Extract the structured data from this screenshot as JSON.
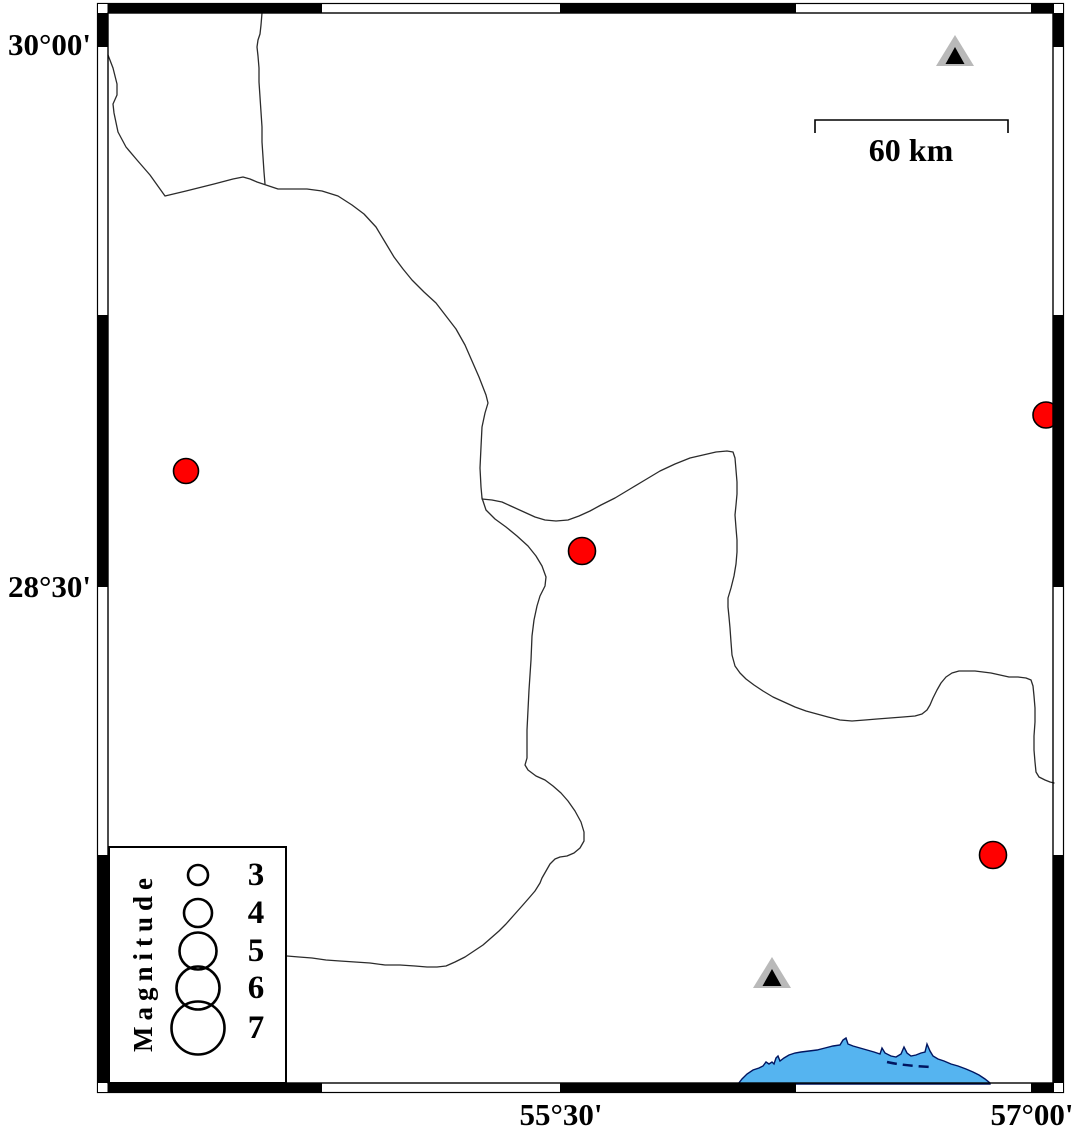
{
  "map": {
    "lat_labels": [
      {
        "text": "30°00'"
      },
      {
        "text": "28°30'"
      }
    ],
    "lon_labels": [
      {
        "text": "55°30'"
      },
      {
        "text": "57°00'"
      }
    ],
    "scale_bar": {
      "label": "60 km"
    },
    "legend": {
      "title": "Magnitude",
      "entries": [
        {
          "label": "3",
          "diameter": 20
        },
        {
          "label": "4",
          "diameter": 28
        },
        {
          "label": "5",
          "diameter": 37
        },
        {
          "label": "6",
          "diameter": 43
        },
        {
          "label": "7",
          "diameter": 53
        }
      ]
    },
    "epicenters": [
      {
        "x": 186,
        "y": 471,
        "r": 12.5
      },
      {
        "x": 582,
        "y": 551,
        "r": 13.5
      },
      {
        "x": 1046,
        "y": 415,
        "r": 13
      },
      {
        "x": 993,
        "y": 855,
        "r": 13.5
      }
    ],
    "stations": [
      {
        "x": 955,
        "y": 51
      },
      {
        "x": 772,
        "y": 973
      }
    ],
    "colors": {
      "epicenter": "#ff0000",
      "epicenter_outline": "#000000",
      "station": "#b9b9b9",
      "station_inner": "#000000",
      "water": "#55b4f0",
      "water_outline": "#001560",
      "boundary_line": "#2b2b2b"
    }
  }
}
